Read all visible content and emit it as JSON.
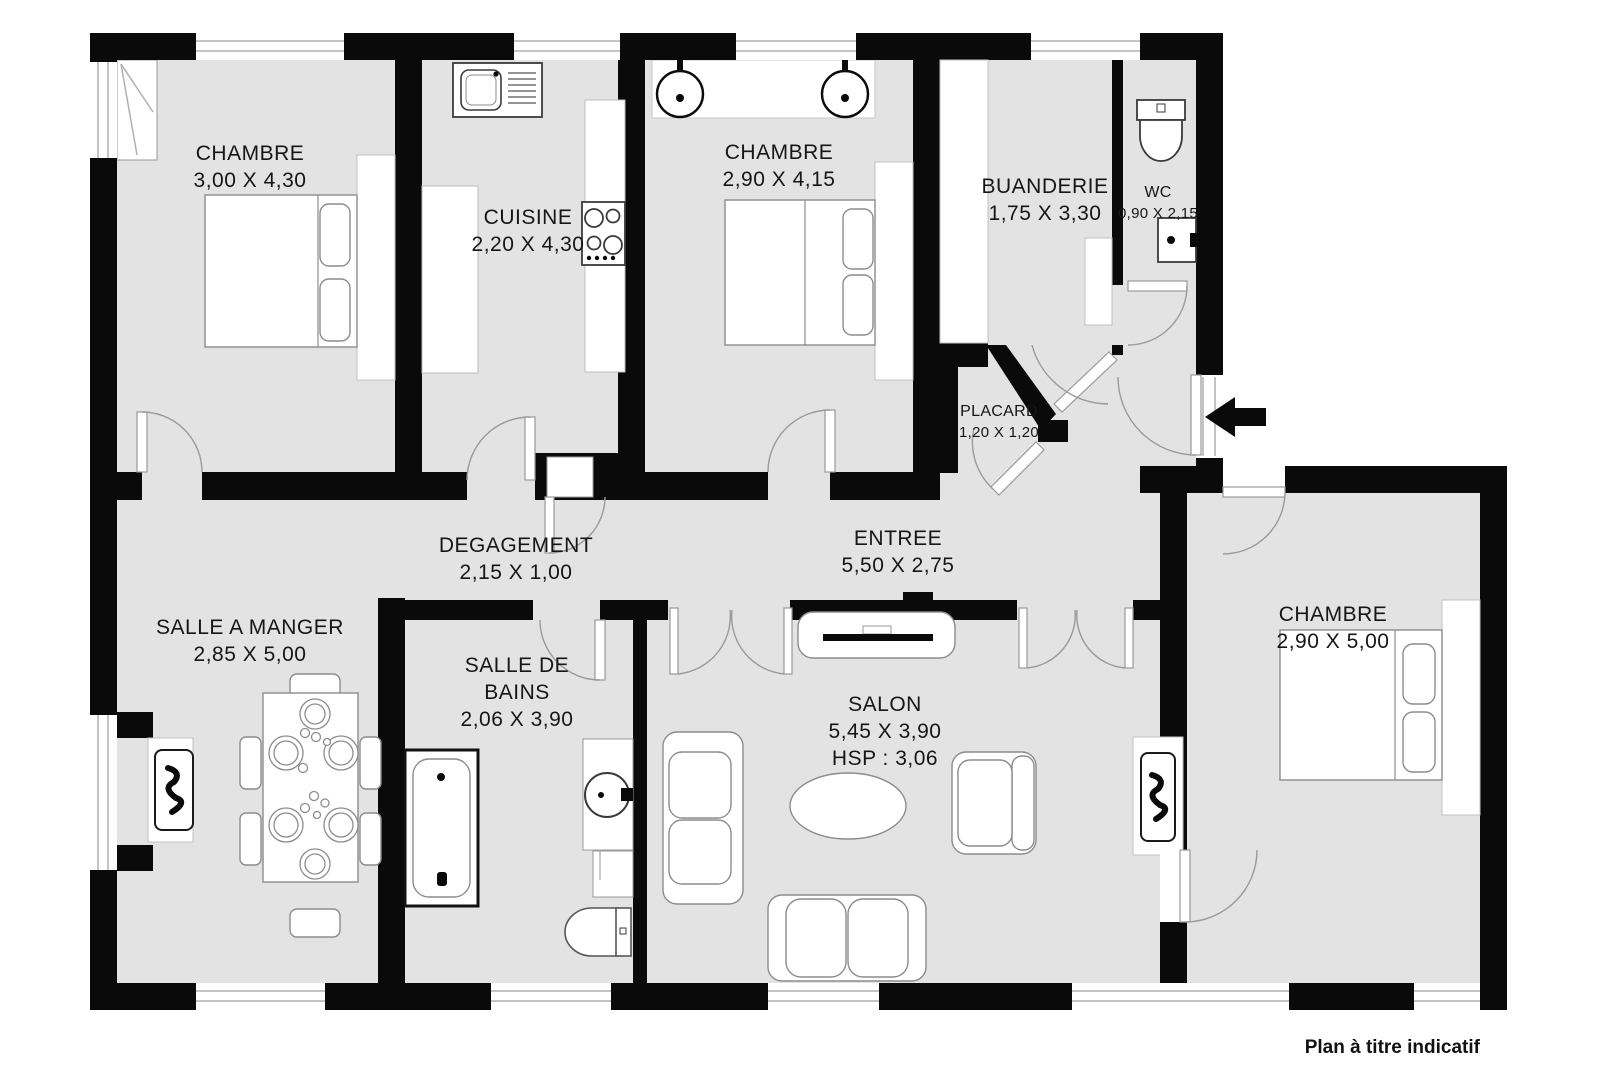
{
  "footer": {
    "text": "Plan à titre indicatif"
  },
  "colors": {
    "floor": "#e3e3e3",
    "wall": "#0a0a0a",
    "window_line": "#b0b0b0",
    "door_arc": "#9a9a9a"
  },
  "rooms": [
    {
      "id": "bedroom-1",
      "label": "CHAMBRE",
      "dims": "3,00 X 4,30"
    },
    {
      "id": "kitchen",
      "label": "CUISINE",
      "dims": "2,20 X 4,30"
    },
    {
      "id": "bedroom-2",
      "label": "CHAMBRE",
      "dims": "2,90 X 4,15"
    },
    {
      "id": "laundry-room",
      "label": "BUANDERIE",
      "dims": "1,75 X 3,30"
    },
    {
      "id": "wc",
      "label": "WC",
      "dims": "0,90 X 2,15"
    },
    {
      "id": "closet",
      "label": "PLACARD",
      "dims": "1,20 X 1,20"
    },
    {
      "id": "hallway",
      "label": "DEGAGEMENT",
      "dims": "2,15 X 1,00"
    },
    {
      "id": "entrance",
      "label": "ENTREE",
      "dims": "5,50 X 2,75"
    },
    {
      "id": "dining-room",
      "label": "SALLE A MANGER",
      "dims": "2,85 X 5,00"
    },
    {
      "id": "bathroom",
      "label": "SALLE DE",
      "label_line2": "BAINS",
      "dims": "2,06 X 3,90"
    },
    {
      "id": "living-room",
      "label": "SALON",
      "dims": "5,45 X 3,90",
      "ceiling_height": "HSP : 3,06"
    },
    {
      "id": "bedroom-3",
      "label": "CHAMBRE",
      "dims": "2,90 X 5,00"
    }
  ]
}
